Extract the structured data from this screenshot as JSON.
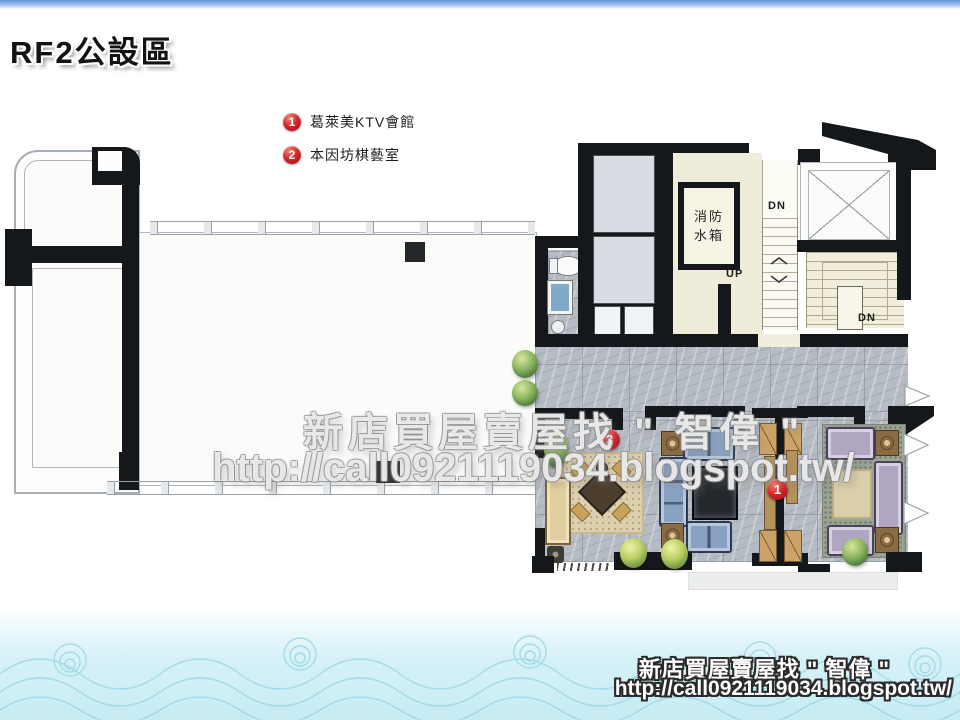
{
  "page": {
    "title": "RF2公設區"
  },
  "legend": {
    "items": [
      {
        "num": "1",
        "label": "葛萊美KTV會館"
      },
      {
        "num": "2",
        "label": "本因坊棋藝室"
      }
    ]
  },
  "plan": {
    "rooms": {
      "fire_tank": {
        "line1": "消防",
        "line2": "水箱"
      }
    },
    "stairs": {
      "dn_upper": "DN",
      "up": "UP",
      "dn_lower": "DN"
    },
    "markers": [
      {
        "num": "1"
      },
      {
        "num": "2"
      }
    ]
  },
  "watermark": {
    "line1": "新店買屋賣屋找 \" 智偉 \"",
    "line2": "http://call0921119034.blogspot.tw/"
  },
  "footer": {
    "line1": "新店買屋賣屋找 \" 智偉 \"",
    "line2": "http://call0921119034.blogspot.tw/"
  },
  "colors": {
    "marker_red": "#c6191f",
    "wall_black": "#15181a",
    "marble_gray": "#b6bcc4",
    "stair_cream": "#f2eedc",
    "wave_cyan": "#cdeef5",
    "top_bar_blue": "#5e92e0"
  }
}
